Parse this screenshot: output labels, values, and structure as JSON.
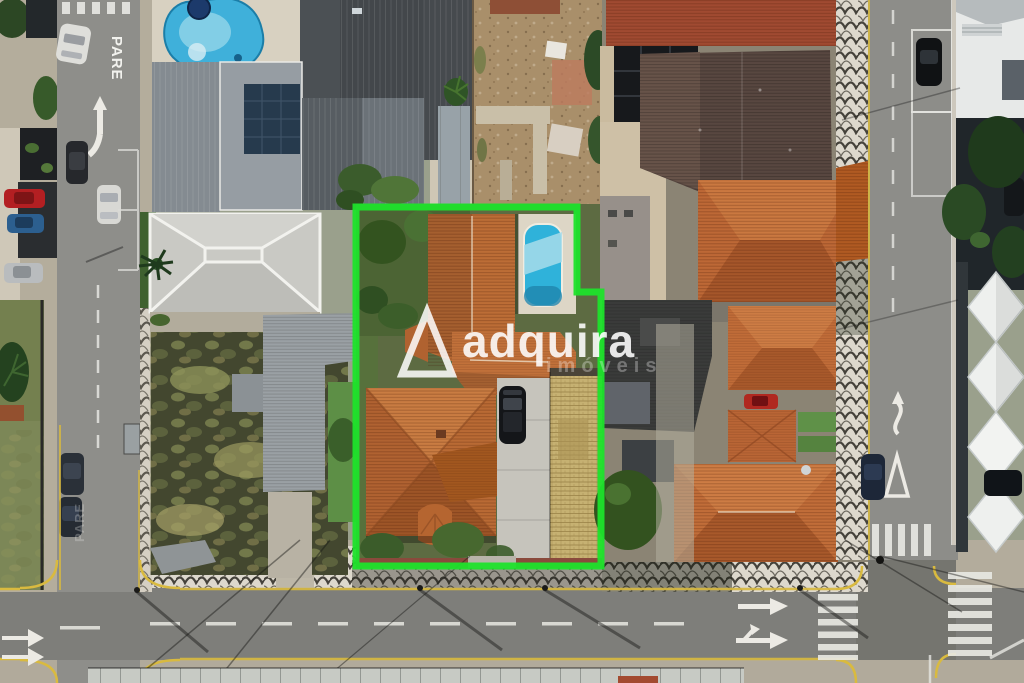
{
  "scene": {
    "type": "aerial-drone-photograph",
    "subject": "Top-down aerial photo of a residential corner block; one property for sale is outlined in bright green",
    "location_style": "Brazilian city block with Portuguese-pavement sidewalks and terracotta roofs"
  },
  "watermark": {
    "brand": "adquira",
    "subtitle": "imóveis",
    "logo": "triangle-a-logo",
    "text_color": "#ffffff"
  },
  "highlight": {
    "label": "property-boundary",
    "color": "#1ee32b"
  },
  "road_markings": {
    "stop_text_top": "PARE",
    "stop_text_faded": "PARE",
    "stop_text_bottom": "PARE"
  },
  "features": {
    "pools": [
      "kidney-pool-top-left",
      "small-pool-inside-boundary"
    ],
    "crosswalks": 4,
    "parked_cars": [
      "red",
      "blue",
      "silver",
      "white",
      "dark-suv",
      "dark-suv",
      "black",
      "dark-blue",
      "small-red",
      "black-pickup"
    ],
    "roads": [
      "left-street-vertical",
      "right-street-vertical",
      "bottom-avenue-horizontal"
    ]
  },
  "palette": {
    "asphalt": "#8d8d89",
    "avenue_asphalt": "#7e7e7a",
    "terracotta_roof": "#bf6c38",
    "aged_dark_roof": "#584740",
    "metal_roof_gray": "#464a4e",
    "pool_blue": "#3ab4dc",
    "mosaic_sidewalk": "#ddd8cd",
    "mosaic_wave": "#45423b",
    "curb_yellow": "#d9ba3f",
    "overgrown_lot": "#43472f",
    "dirt_lot": "#a98f6a",
    "lawn": "#5d8f46"
  }
}
